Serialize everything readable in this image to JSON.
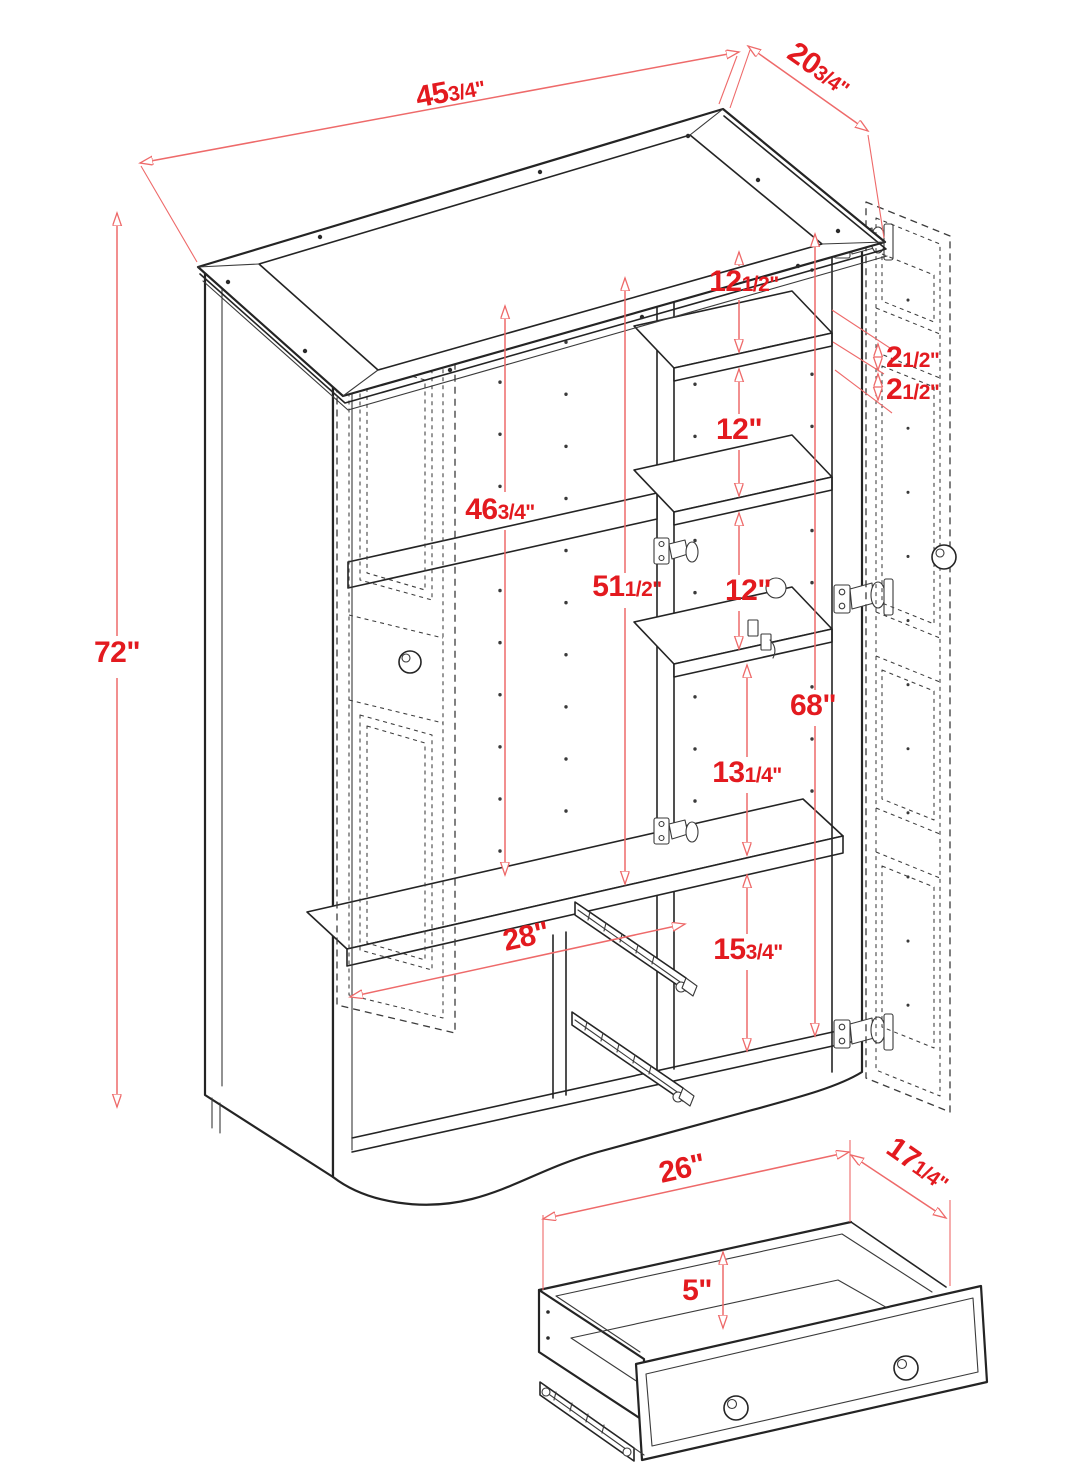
{
  "colors": {
    "dim_line": "#ee6a6a",
    "dim_text": "#e31a1f",
    "outline": "#242424",
    "ghost": "#3c3c3c",
    "background": "#ffffff"
  },
  "dimensions": {
    "top_width": {
      "main": "45",
      "frac": "3/4\""
    },
    "top_depth": {
      "main": "20",
      "frac": "3/4\""
    },
    "overall_height": {
      "main": "72\"",
      "frac": ""
    },
    "left_interior_height": {
      "main": "46",
      "frac": "3/4\""
    },
    "middle_interior_height": {
      "main": "51",
      "frac": "1/2\""
    },
    "top_shelf_gap": {
      "main": "12",
      "frac": "1/2\""
    },
    "shelf_gap_upper": {
      "main": "12\"",
      "frac": ""
    },
    "door_gap_a": {
      "main": "2",
      "frac": "1/2\""
    },
    "door_gap_b": {
      "main": "2",
      "frac": "1/2\""
    },
    "shelf_gap_mid": {
      "main": "12\"",
      "frac": ""
    },
    "right_interior_height": {
      "main": "68\"",
      "frac": ""
    },
    "shelf_gap_lower": {
      "main": "13",
      "frac": "1/4\""
    },
    "bottom_section_height": {
      "main": "15",
      "frac": "3/4\""
    },
    "left_compartment_width": {
      "main": "28\"",
      "frac": ""
    },
    "drawer_width": {
      "main": "26\"",
      "frac": ""
    },
    "drawer_depth": {
      "main": "17",
      "frac": "1/4\""
    },
    "drawer_height": {
      "main": "5\"",
      "frac": ""
    }
  }
}
